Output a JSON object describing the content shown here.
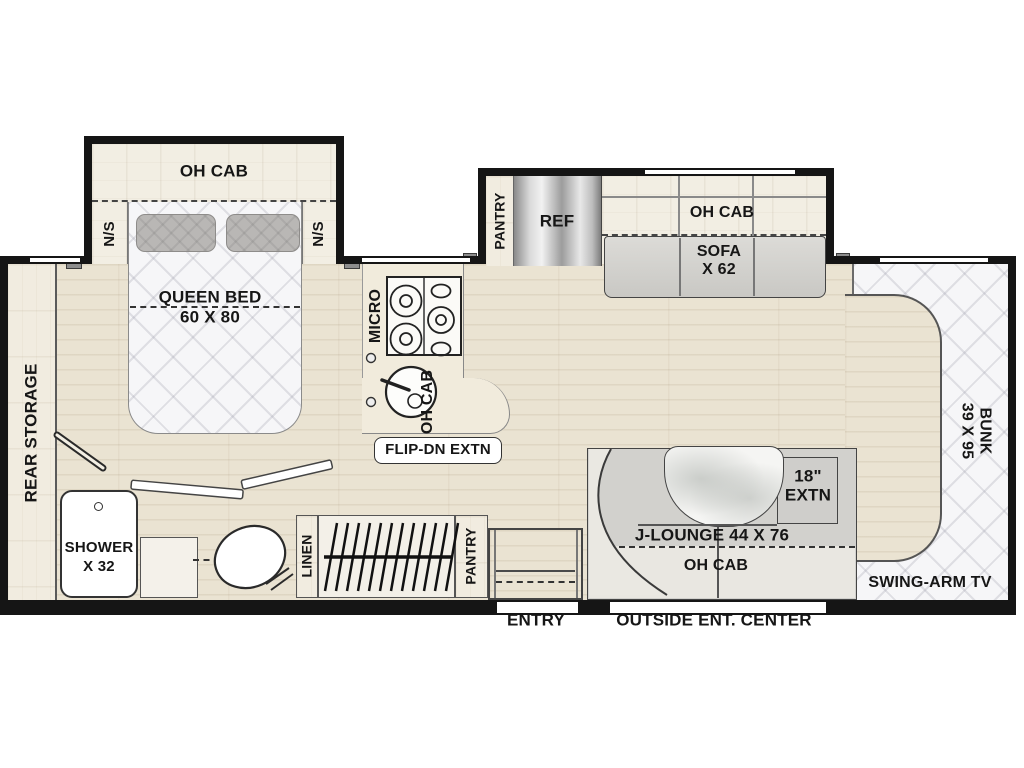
{
  "labels": {
    "bedroom_oh_cab": "OH CAB",
    "ns_left": "N/S",
    "ns_right": "N/S",
    "queen_bed": "QUEEN BED",
    "queen_bed_size": "60 X 80",
    "rear_storage": "REAR STORAGE",
    "micro": "MICRO",
    "kitchen_oh_cab": "OH CAB",
    "flip_dn_extn": "FLIP-DN EXTN",
    "shower": "SHOWER",
    "shower_size": "X 32",
    "linen": "LINEN",
    "pantry_bottom": "PANTRY",
    "entry": "ENTRY",
    "pantry_top": "PANTRY",
    "ref": "REF",
    "sofa_oh_cab": "OH CAB",
    "sofa": "SOFA",
    "sofa_size": "X 62",
    "j_lounge": "J-LOUNGE 44 X 76",
    "extn_size": "18\"",
    "extn": "EXTN",
    "lounge_oh_cab": "OH CAB",
    "outside_ent_center": "OUTSIDE ENT. CENTER",
    "swing_arm_tv": "SWING-ARM TV",
    "bunk": "BUNK",
    "bunk_size": "39 X 95"
  },
  "colors": {
    "wall": "#151515",
    "floor_wood": "#eae3d2",
    "cabinet_wood": "#f2eee3",
    "mattress_quilt": "#f6f6f8",
    "upholstery_gray": "#d2d1cd",
    "pillow_gray": "#b9b7b5",
    "fridge_metal": "#c0c0c0"
  }
}
